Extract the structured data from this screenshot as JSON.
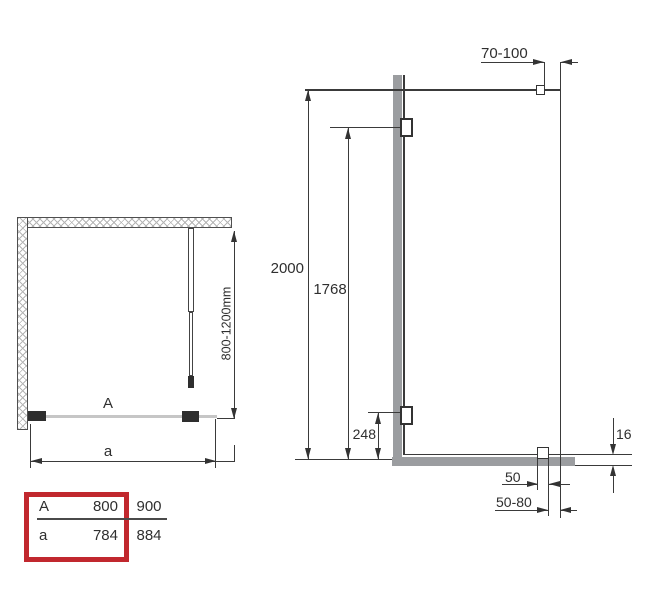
{
  "drawing": {
    "plan": {
      "enclosure_label": "A",
      "width_label": "a",
      "depth_range": "800-1200mm"
    },
    "elevation": {
      "wall_offset_range": "70-100",
      "total_height": "2000",
      "glass_height": "1768",
      "lower_bracket_height": "248",
      "rail_height": "16",
      "clamp_width": "50",
      "edge_gap_range": "50-80"
    },
    "size_table": {
      "highlight_color": "#c1282e",
      "rows": [
        {
          "label": "A",
          "size_800": "800",
          "size_900": "900"
        },
        {
          "label": "a",
          "size_800": "784",
          "size_900": "884"
        }
      ]
    }
  }
}
